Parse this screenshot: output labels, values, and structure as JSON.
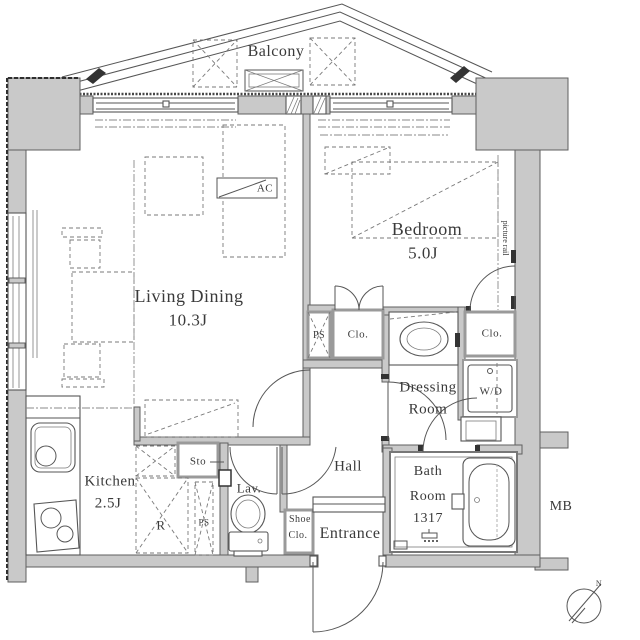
{
  "plan": {
    "balcony": {
      "label": "Balcony"
    },
    "bedroom": {
      "name": "Bedroom",
      "size": "5.0J",
      "picture_rail": "picture rail",
      "closet": "Clo.",
      "ps": "PS"
    },
    "living": {
      "name": "Living Dining",
      "size": "10.3J",
      "ac": "AC"
    },
    "kitchen": {
      "name": "Kitchen",
      "size": "2.5J",
      "refrigerator": "R",
      "storage": "Sto",
      "ps": "PS"
    },
    "lavatory": {
      "label": "Lav."
    },
    "hall": {
      "label": "Hall"
    },
    "entrance": {
      "label": "Entrance",
      "shoe_closet_line1": "Shoe",
      "shoe_closet_line2": "Clo."
    },
    "dressing": {
      "line1": "Dressing",
      "line2": "Room",
      "closet": "Clo.",
      "washer_dryer": "W/D"
    },
    "bath": {
      "line1": "Bath",
      "line2": "Room",
      "size": "1317"
    },
    "meter_box": "MB",
    "compass_north": "N"
  },
  "colors": {
    "wall_fill": "#c9c9c9",
    "line": "#565656",
    "text": "#3a3a3a",
    "background": "#ffffff"
  }
}
